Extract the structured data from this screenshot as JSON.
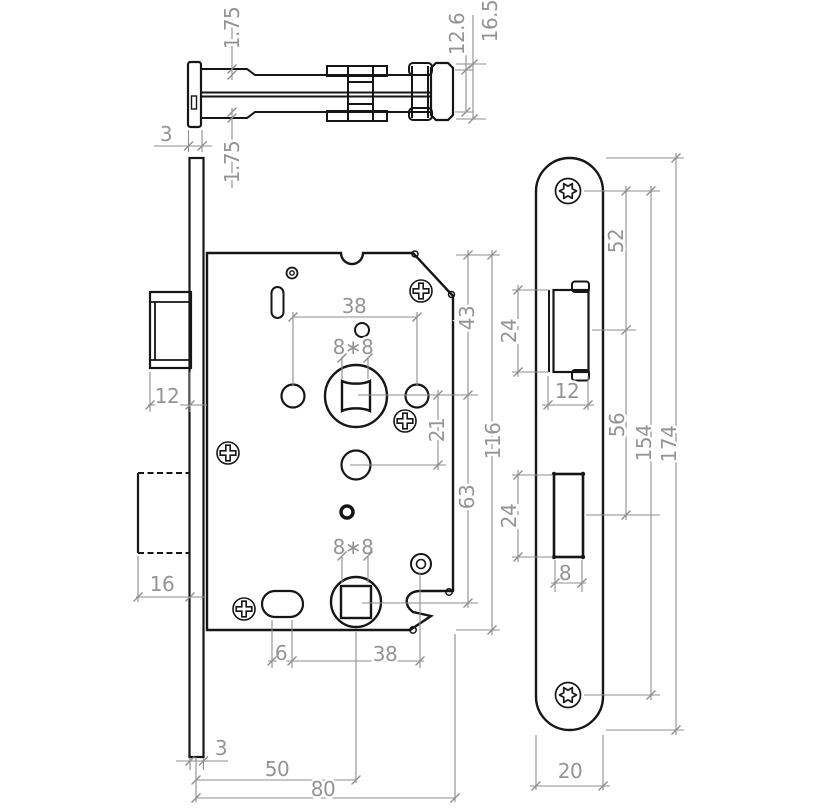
{
  "meta": {
    "drawing_type": "technical dimension drawing",
    "subject": "mortise door lock - three orthographic views"
  },
  "colors": {
    "outline": "#161616",
    "dimension": "#8e8e8e",
    "background": "#ffffff"
  },
  "icons": {
    "case_screw": "phillips-cross-screw",
    "faceplate_screw": "torx-star-screw"
  },
  "top_view": {
    "label_lip_thickness_top": "1.75",
    "label_lip_thickness_bottom": "1.75",
    "label_faceplate_thickness": "3",
    "label_body_height": "12.6",
    "label_total_height": "16.5"
  },
  "front_view": {
    "label_latch_width": "12",
    "label_deadbolt_width": "16",
    "label_hole_spacing": "38",
    "label_spindle_square_top": "8∗8",
    "label_top_to_spindle": "43",
    "label_spindle_to_hole": "21",
    "label_case_height": "116",
    "label_spindle_to_lower_spindle": "63",
    "label_spindle_square_bottom": "8∗8",
    "label_slot_offset": "6",
    "label_slot_to_spindle": "38",
    "label_faceplate_thickness_bottom": "3",
    "label_backset": "50",
    "label_case_depth": "80"
  },
  "faceplate_view": {
    "label_screw_to_latch": "52",
    "label_latch_cutout_height": "24",
    "label_latch_cutout_width": "12",
    "label_latch_to_deadbolt": "56",
    "label_screw_spacing": "154",
    "label_plate_length": "174",
    "label_deadbolt_cutout_height": "24",
    "label_deadbolt_cutout_width": "8",
    "label_plate_width": "20"
  }
}
